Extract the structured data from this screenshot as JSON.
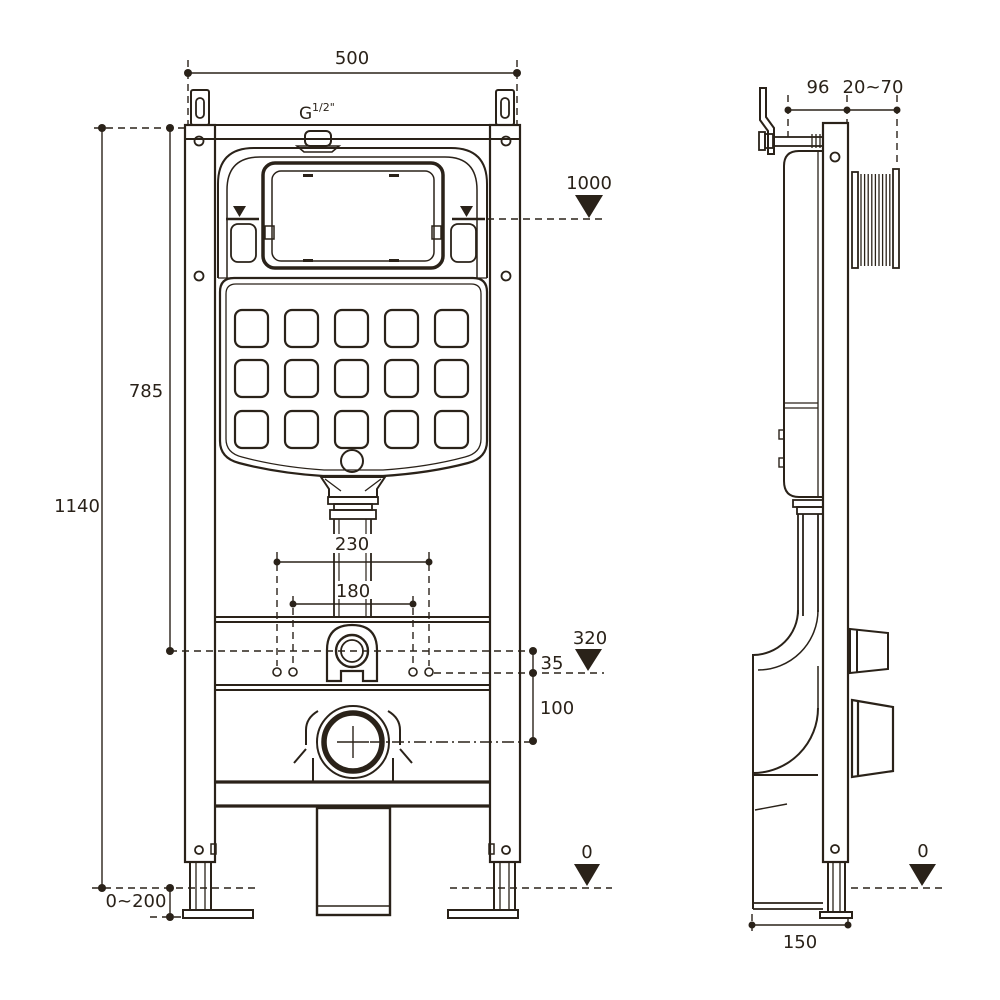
{
  "drawing": {
    "title": "concealed-cistern-wc-frame-installation-drawing",
    "line_color": "#2a2219",
    "background": "#ffffff",
    "front": {
      "width_top": "500",
      "thread_g": "G",
      "thread_size": "1/2\"",
      "flush_level": "1000",
      "tank_height": "785",
      "overall_height": "1140",
      "span_outer": "230",
      "span_inner": "180",
      "fixing_height": "320",
      "fixing_offset": "35",
      "outlet_drop": "100",
      "foot_range": "0~200",
      "datum": "0"
    },
    "side": {
      "depth": "96",
      "wall_gap": "20~70",
      "datum": "0",
      "base_depth": "150"
    }
  }
}
